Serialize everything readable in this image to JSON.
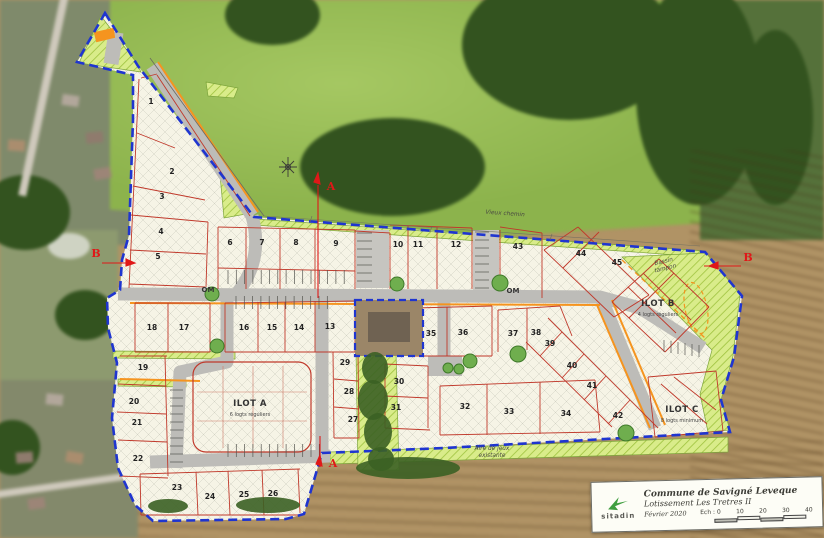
{
  "title_block": {
    "logo_text": "sitadin",
    "line1": "Commune de Savigné Leveque",
    "line2": "Lotissement Les Tretres II",
    "date": "Février 2020",
    "scale_label": "Ech : 0",
    "scale_ticks": [
      "10",
      "20",
      "30",
      "40"
    ]
  },
  "plan": {
    "lots": [
      {
        "n": "1",
        "x": 151,
        "y": 104
      },
      {
        "n": "2",
        "x": 172,
        "y": 174
      },
      {
        "n": "3",
        "x": 162,
        "y": 199
      },
      {
        "n": "4",
        "x": 161,
        "y": 234
      },
      {
        "n": "5",
        "x": 158,
        "y": 259
      },
      {
        "n": "6",
        "x": 230,
        "y": 245
      },
      {
        "n": "7",
        "x": 262,
        "y": 245
      },
      {
        "n": "8",
        "x": 296,
        "y": 245
      },
      {
        "n": "9",
        "x": 336,
        "y": 246
      },
      {
        "n": "10",
        "x": 398,
        "y": 247
      },
      {
        "n": "11",
        "x": 418,
        "y": 247
      },
      {
        "n": "12",
        "x": 456,
        "y": 247
      },
      {
        "n": "13",
        "x": 330,
        "y": 329
      },
      {
        "n": "14",
        "x": 299,
        "y": 330
      },
      {
        "n": "15",
        "x": 272,
        "y": 330
      },
      {
        "n": "16",
        "x": 244,
        "y": 330
      },
      {
        "n": "17",
        "x": 184,
        "y": 330
      },
      {
        "n": "18",
        "x": 152,
        "y": 330
      },
      {
        "n": "19",
        "x": 143,
        "y": 370
      },
      {
        "n": "20",
        "x": 134,
        "y": 404
      },
      {
        "n": "21",
        "x": 137,
        "y": 425
      },
      {
        "n": "22",
        "x": 138,
        "y": 461
      },
      {
        "n": "23",
        "x": 177,
        "y": 490
      },
      {
        "n": "24",
        "x": 210,
        "y": 499
      },
      {
        "n": "25",
        "x": 244,
        "y": 497
      },
      {
        "n": "26",
        "x": 273,
        "y": 496
      },
      {
        "n": "27",
        "x": 353,
        "y": 422
      },
      {
        "n": "28",
        "x": 349,
        "y": 394
      },
      {
        "n": "29",
        "x": 345,
        "y": 365
      },
      {
        "n": "30",
        "x": 399,
        "y": 384
      },
      {
        "n": "31",
        "x": 396,
        "y": 410
      },
      {
        "n": "32",
        "x": 465,
        "y": 409
      },
      {
        "n": "33",
        "x": 509,
        "y": 414
      },
      {
        "n": "34",
        "x": 566,
        "y": 416
      },
      {
        "n": "35",
        "x": 431,
        "y": 336
      },
      {
        "n": "36",
        "x": 463,
        "y": 335
      },
      {
        "n": "37",
        "x": 513,
        "y": 336
      },
      {
        "n": "38",
        "x": 536,
        "y": 335
      },
      {
        "n": "39",
        "x": 550,
        "y": 346
      },
      {
        "n": "40",
        "x": 572,
        "y": 368
      },
      {
        "n": "41",
        "x": 592,
        "y": 388
      },
      {
        "n": "42",
        "x": 618,
        "y": 418
      },
      {
        "n": "43",
        "x": 518,
        "y": 249
      },
      {
        "n": "44",
        "x": 581,
        "y": 256
      },
      {
        "n": "45",
        "x": 617,
        "y": 265
      }
    ],
    "ilots": [
      {
        "label": "ILOT A",
        "sub": "6 logts réguliers",
        "x": 250,
        "y": 406
      },
      {
        "label": "ILOT B",
        "sub": "4 logts réguliers",
        "x": 658,
        "y": 306
      },
      {
        "label": "ILOT C",
        "sub": "8 logts minimum",
        "x": 682,
        "y": 412
      }
    ],
    "annotations": [
      {
        "text": "OM",
        "x": 208,
        "y": 292,
        "cls": "anno-om"
      },
      {
        "text": "OM",
        "x": 513,
        "y": 293,
        "cls": "anno-om"
      },
      {
        "text": "Bassin\ntampon",
        "x": 664,
        "y": 263,
        "rot": -14,
        "cls": "anno"
      },
      {
        "text": "Aire de jeux\nexistante",
        "x": 492,
        "y": 450,
        "cls": "anno"
      },
      {
        "text": "Vieux chemin",
        "x": 505,
        "y": 215,
        "rot": 4,
        "cls": "anno"
      }
    ],
    "section_markers": [
      {
        "label": "A",
        "x": 331,
        "y": 190
      },
      {
        "label": "A",
        "x": 333,
        "y": 467
      },
      {
        "label": "B",
        "x": 96,
        "y": 257
      },
      {
        "label": "B",
        "x": 748,
        "y": 261
      }
    ],
    "colors": {
      "boundary_blue": "#1f35d0",
      "lot_line_red": "#c0392b",
      "road_gray": "#bdbcb8",
      "green_area": "#d9ec8a",
      "curb_orange": "#f5941f",
      "plan_cream": "#f6f4e6",
      "section_red": "#e01818"
    }
  }
}
